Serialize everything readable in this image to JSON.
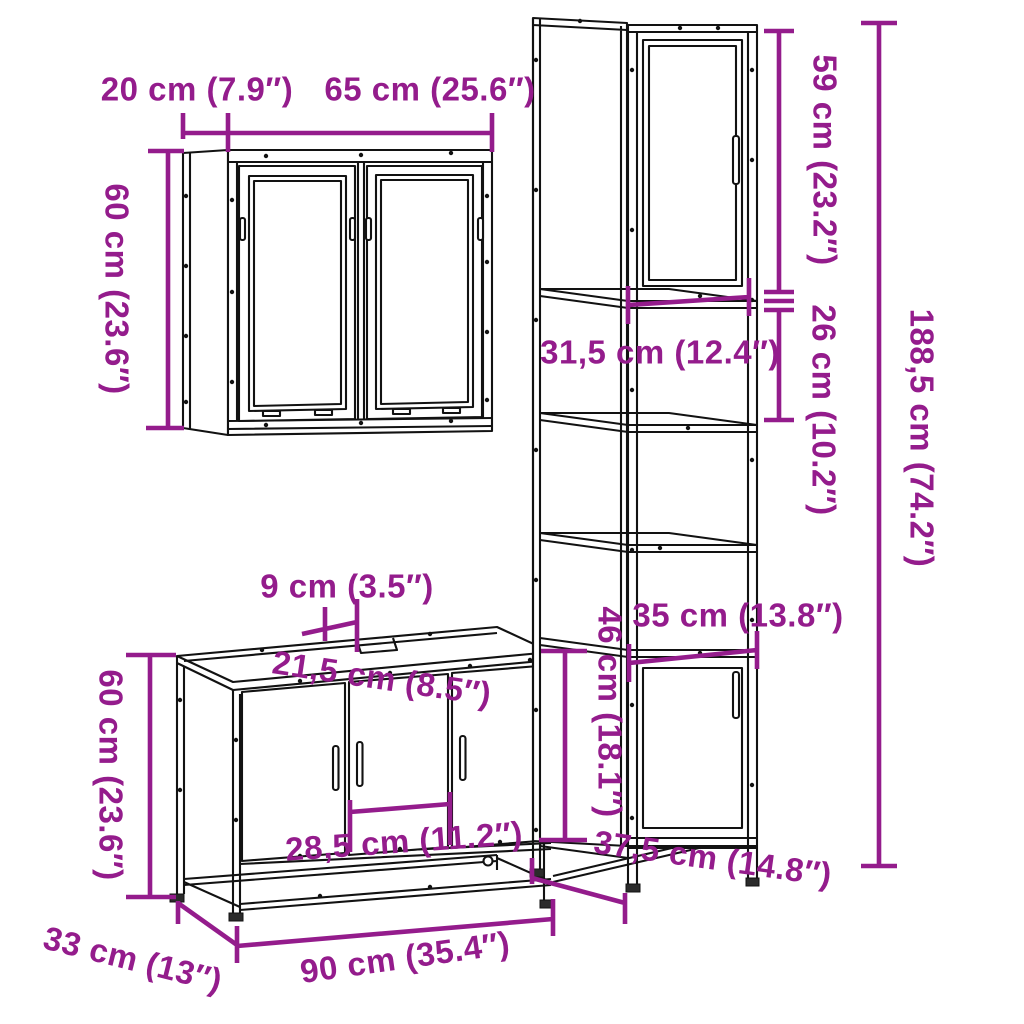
{
  "palette": {
    "dimension_color": "#941C8C",
    "drawing_color": "#121212",
    "background": "#ffffff"
  },
  "diagram": {
    "mirror_cabinet": {
      "labels": {
        "depth": "20 cm (7.9″)",
        "width": "65 cm (25.6″)",
        "height": "60 cm (23.6″)"
      }
    },
    "tall_cabinet": {
      "labels": {
        "upper_door_height": "59 cm (23.2″)",
        "open_compartment_height": "26 cm (10.2″)",
        "total_height": "188,5 cm (74.2″)",
        "inner_width": "31,5 cm (12.4″)",
        "lower_door_width": "35 cm (13.8″)",
        "lower_section_height": "46 cm (18.1″)",
        "depth": "37,5 cm (14.8″)"
      }
    },
    "sink_cabinet": {
      "labels": {
        "cutout_width": "9 cm (3.5″)",
        "cutout_depth": "21,5 cm (8.5″)",
        "height": "60 cm (23.6″)",
        "middle_door_width": "28,5 cm (11.2″)",
        "depth": "33 cm (13″)",
        "width": "90 cm (35.4″)"
      }
    }
  }
}
